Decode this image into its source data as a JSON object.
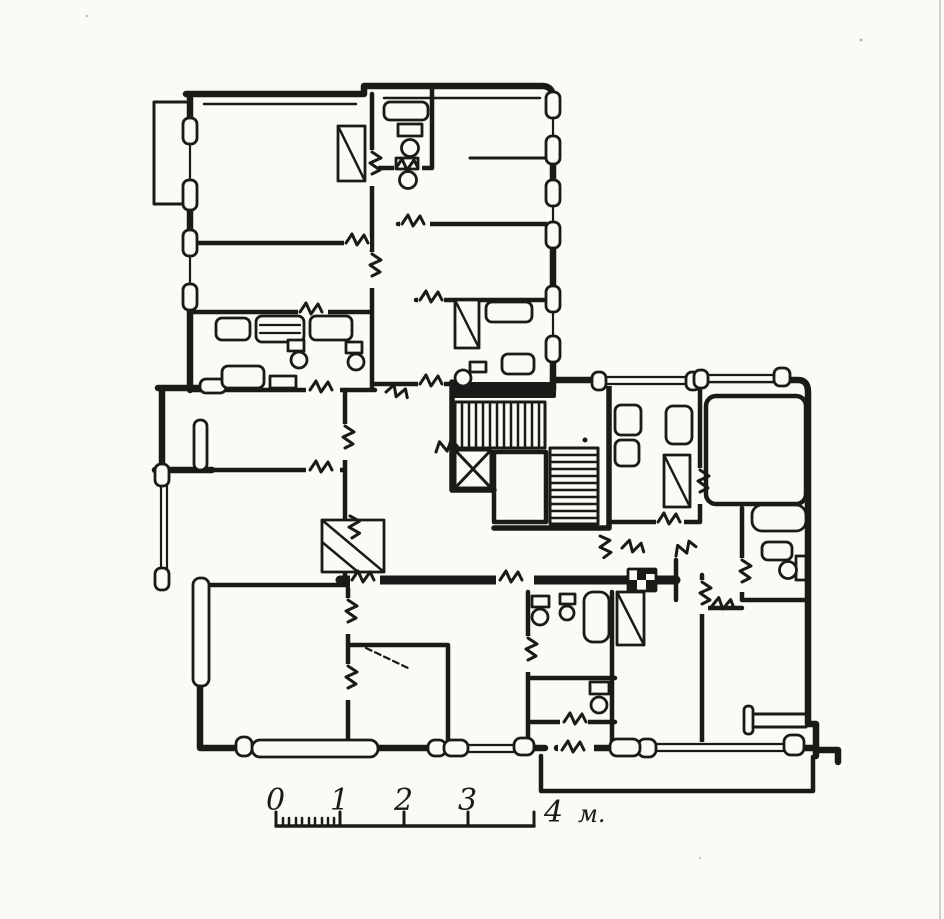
{
  "palette": {
    "ink": "#1a1a18",
    "paper": "#fbfaf4"
  },
  "scale_bar": {
    "labels": [
      "0",
      "1",
      "2",
      "3",
      "4"
    ],
    "unit": "м."
  },
  "symbols": {
    "stair_flight": "parallel-line-hatch",
    "elevator_shaft": "crossed-box",
    "wardrobe": "rect-with-diagonal",
    "toilet": "tank-and-bowl",
    "bathtub": "rounded-rect",
    "window": "double-line-with-sill-blocks",
    "door": "jagged-opening",
    "vent_shaft": "checkered-square"
  }
}
